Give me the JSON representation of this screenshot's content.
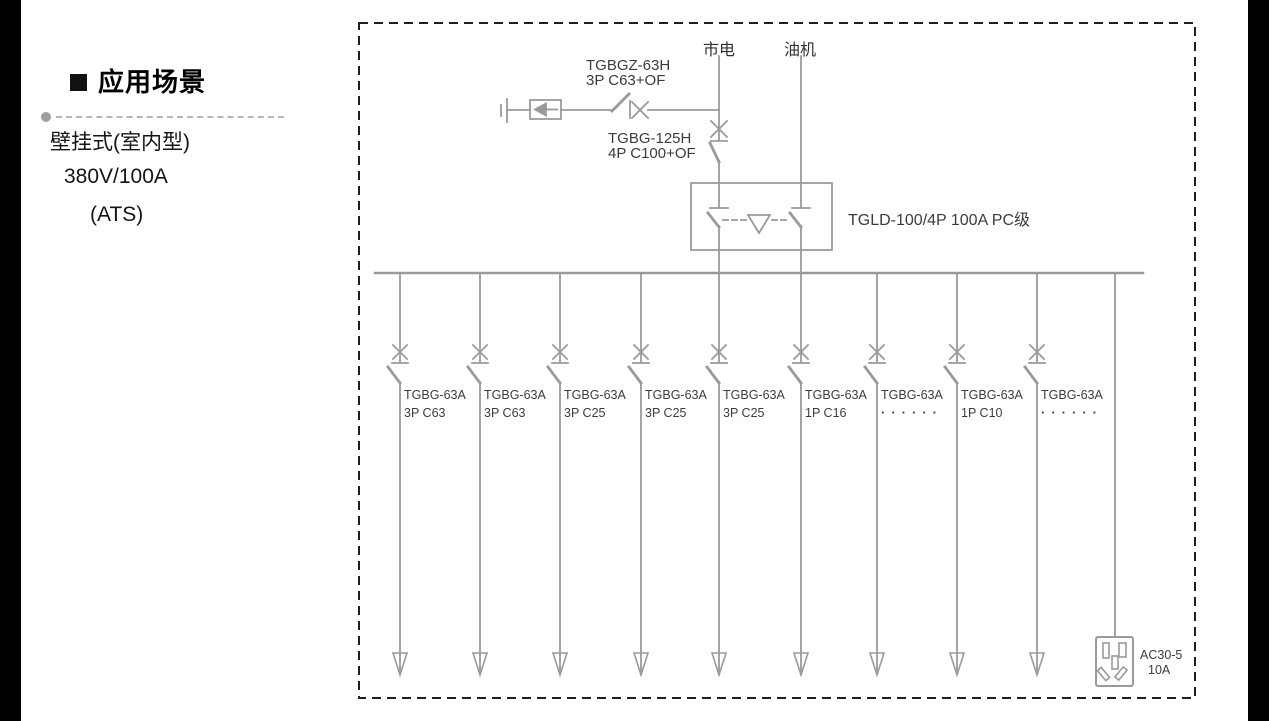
{
  "panel": {
    "heading": "应用场景",
    "lines": [
      "壁挂式(室内型)",
      "380V/100A",
      "(ATS)"
    ]
  },
  "diagram": {
    "mains_label": "市电",
    "generator_label": "油机",
    "surge_breaker": {
      "model": "TGBGZ-63H",
      "spec": "3P C63+OF"
    },
    "main_breaker": {
      "model": "TGBG-125H",
      "spec": "4P C100+OF"
    },
    "transfer_switch_label": "TGLD-100/4P 100A PC级",
    "feeders": [
      {
        "model": "TGBG-63A",
        "spec": "3P C63"
      },
      {
        "model": "TGBG-63A",
        "spec": "3P C63"
      },
      {
        "model": "TGBG-63A",
        "spec": "3P C25"
      },
      {
        "model": "TGBG-63A",
        "spec": "3P C25"
      },
      {
        "model": "TGBG-63A",
        "spec": "3P C25"
      },
      {
        "model": "TGBG-63A",
        "spec": "1P C16"
      },
      {
        "model": "TGBG-63A",
        "spec": "······"
      },
      {
        "model": "TGBG-63A",
        "spec": "1P C10"
      },
      {
        "model": "TGBG-63A",
        "spec": "······"
      }
    ],
    "socket": {
      "model": "AC30-5",
      "rating": "10A"
    }
  },
  "colors": {
    "diagram_line": "#9a9a9a",
    "label_text": "#3c3c3c",
    "border_dash": "#1f1f1f"
  }
}
